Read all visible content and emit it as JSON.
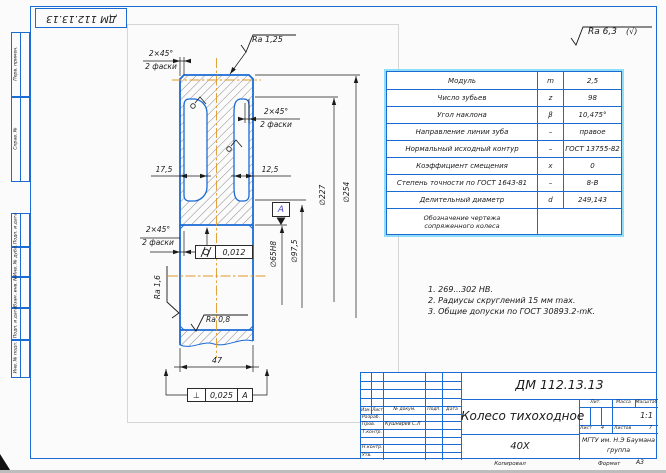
{
  "corner_stamp": "ДМ 112.13.13",
  "general_roughness": {
    "value": "Ra 6,3",
    "bracket": "(√)"
  },
  "gear_table": {
    "rows": [
      {
        "label": "Модуль",
        "sym": "m",
        "val": "2,5"
      },
      {
        "label": "Число зубьев",
        "sym": "z",
        "val": "98"
      },
      {
        "label": "Угол наклона",
        "sym": "β",
        "val": "10,475°"
      },
      {
        "label": "Направление линии зуба",
        "sym": "–",
        "val": "правое"
      },
      {
        "label": "Нормальный исходный контур",
        "sym": "–",
        "val": "ГОСТ 13755-82"
      },
      {
        "label": "Коэффициент смещения",
        "sym": "x",
        "val": "0"
      },
      {
        "label": "Степень точности по ГОСТ 1643-81",
        "sym": "–",
        "val": "8-В"
      },
      {
        "label": "Делительный диаметр",
        "sym": "d",
        "val": "249,143"
      }
    ],
    "footer_label": "Обозначение чертежа сопряженного колеса"
  },
  "notes": {
    "n1": "1. 269...302 НВ.",
    "n2": "2. Радиусы скруглений 15 мм max.",
    "n3": "3. Общие допуски по ГОСТ 30893.2-mK."
  },
  "dims": {
    "ra_od": "Ra 1,25",
    "ra_face": "Ra 1,6",
    "ra_bore": "Ra 0,8",
    "chamfer": "2×45°",
    "chamfer_note": "2 фаски",
    "web_left": "17,5",
    "web_right": "12,5",
    "bore": "∅65H8",
    "hub": "∅97,5",
    "rim": "∅227",
    "od": "∅254",
    "width": "47",
    "cyl_tol": "0,012",
    "perp_sym": "⊥",
    "perp_tol": "0,025",
    "datum": "А"
  },
  "title_block": {
    "doc_number": "ДМ 112.13.13",
    "part_name": "Колесо тихоходное",
    "material": "40Х",
    "org": "МГТУ им. Н.Э Баумана",
    "group": "группа",
    "lit_label": "Лит.",
    "mass_label": "Масса",
    "scale_label": "Масштаб",
    "scale": "1:1",
    "sheet_label": "Лист",
    "sheet_num": "4",
    "sheets_label": "Листов",
    "sheets_num": "7",
    "cols": [
      "Изм.",
      "Лист",
      "№ докум.",
      "Подп.",
      "Дата"
    ],
    "sig_rows": [
      {
        "label": "Разраб.",
        "name": ""
      },
      {
        "label": "Пров.",
        "name": "Кушнарев С.Л"
      },
      {
        "label": "Т.контр.",
        "name": ""
      },
      {
        "label": "",
        "name": ""
      },
      {
        "label": "Н.контр.",
        "name": ""
      },
      {
        "label": "Утв.",
        "name": ""
      }
    ],
    "copied": "Копировал",
    "format_label": "Формат",
    "format": "А3"
  },
  "side_stamps": [
    "Перв. примен.",
    "Справ. №",
    "Подп. и дата",
    "Инв. № дубл.",
    "Взам. инв. №",
    "Подп. и дата",
    "Инв. № подл."
  ],
  "colors": {
    "line_blue": "#1b6bd5",
    "centerline_orange": "#e09a28",
    "highlight_cyan": "#7fd8f2"
  }
}
